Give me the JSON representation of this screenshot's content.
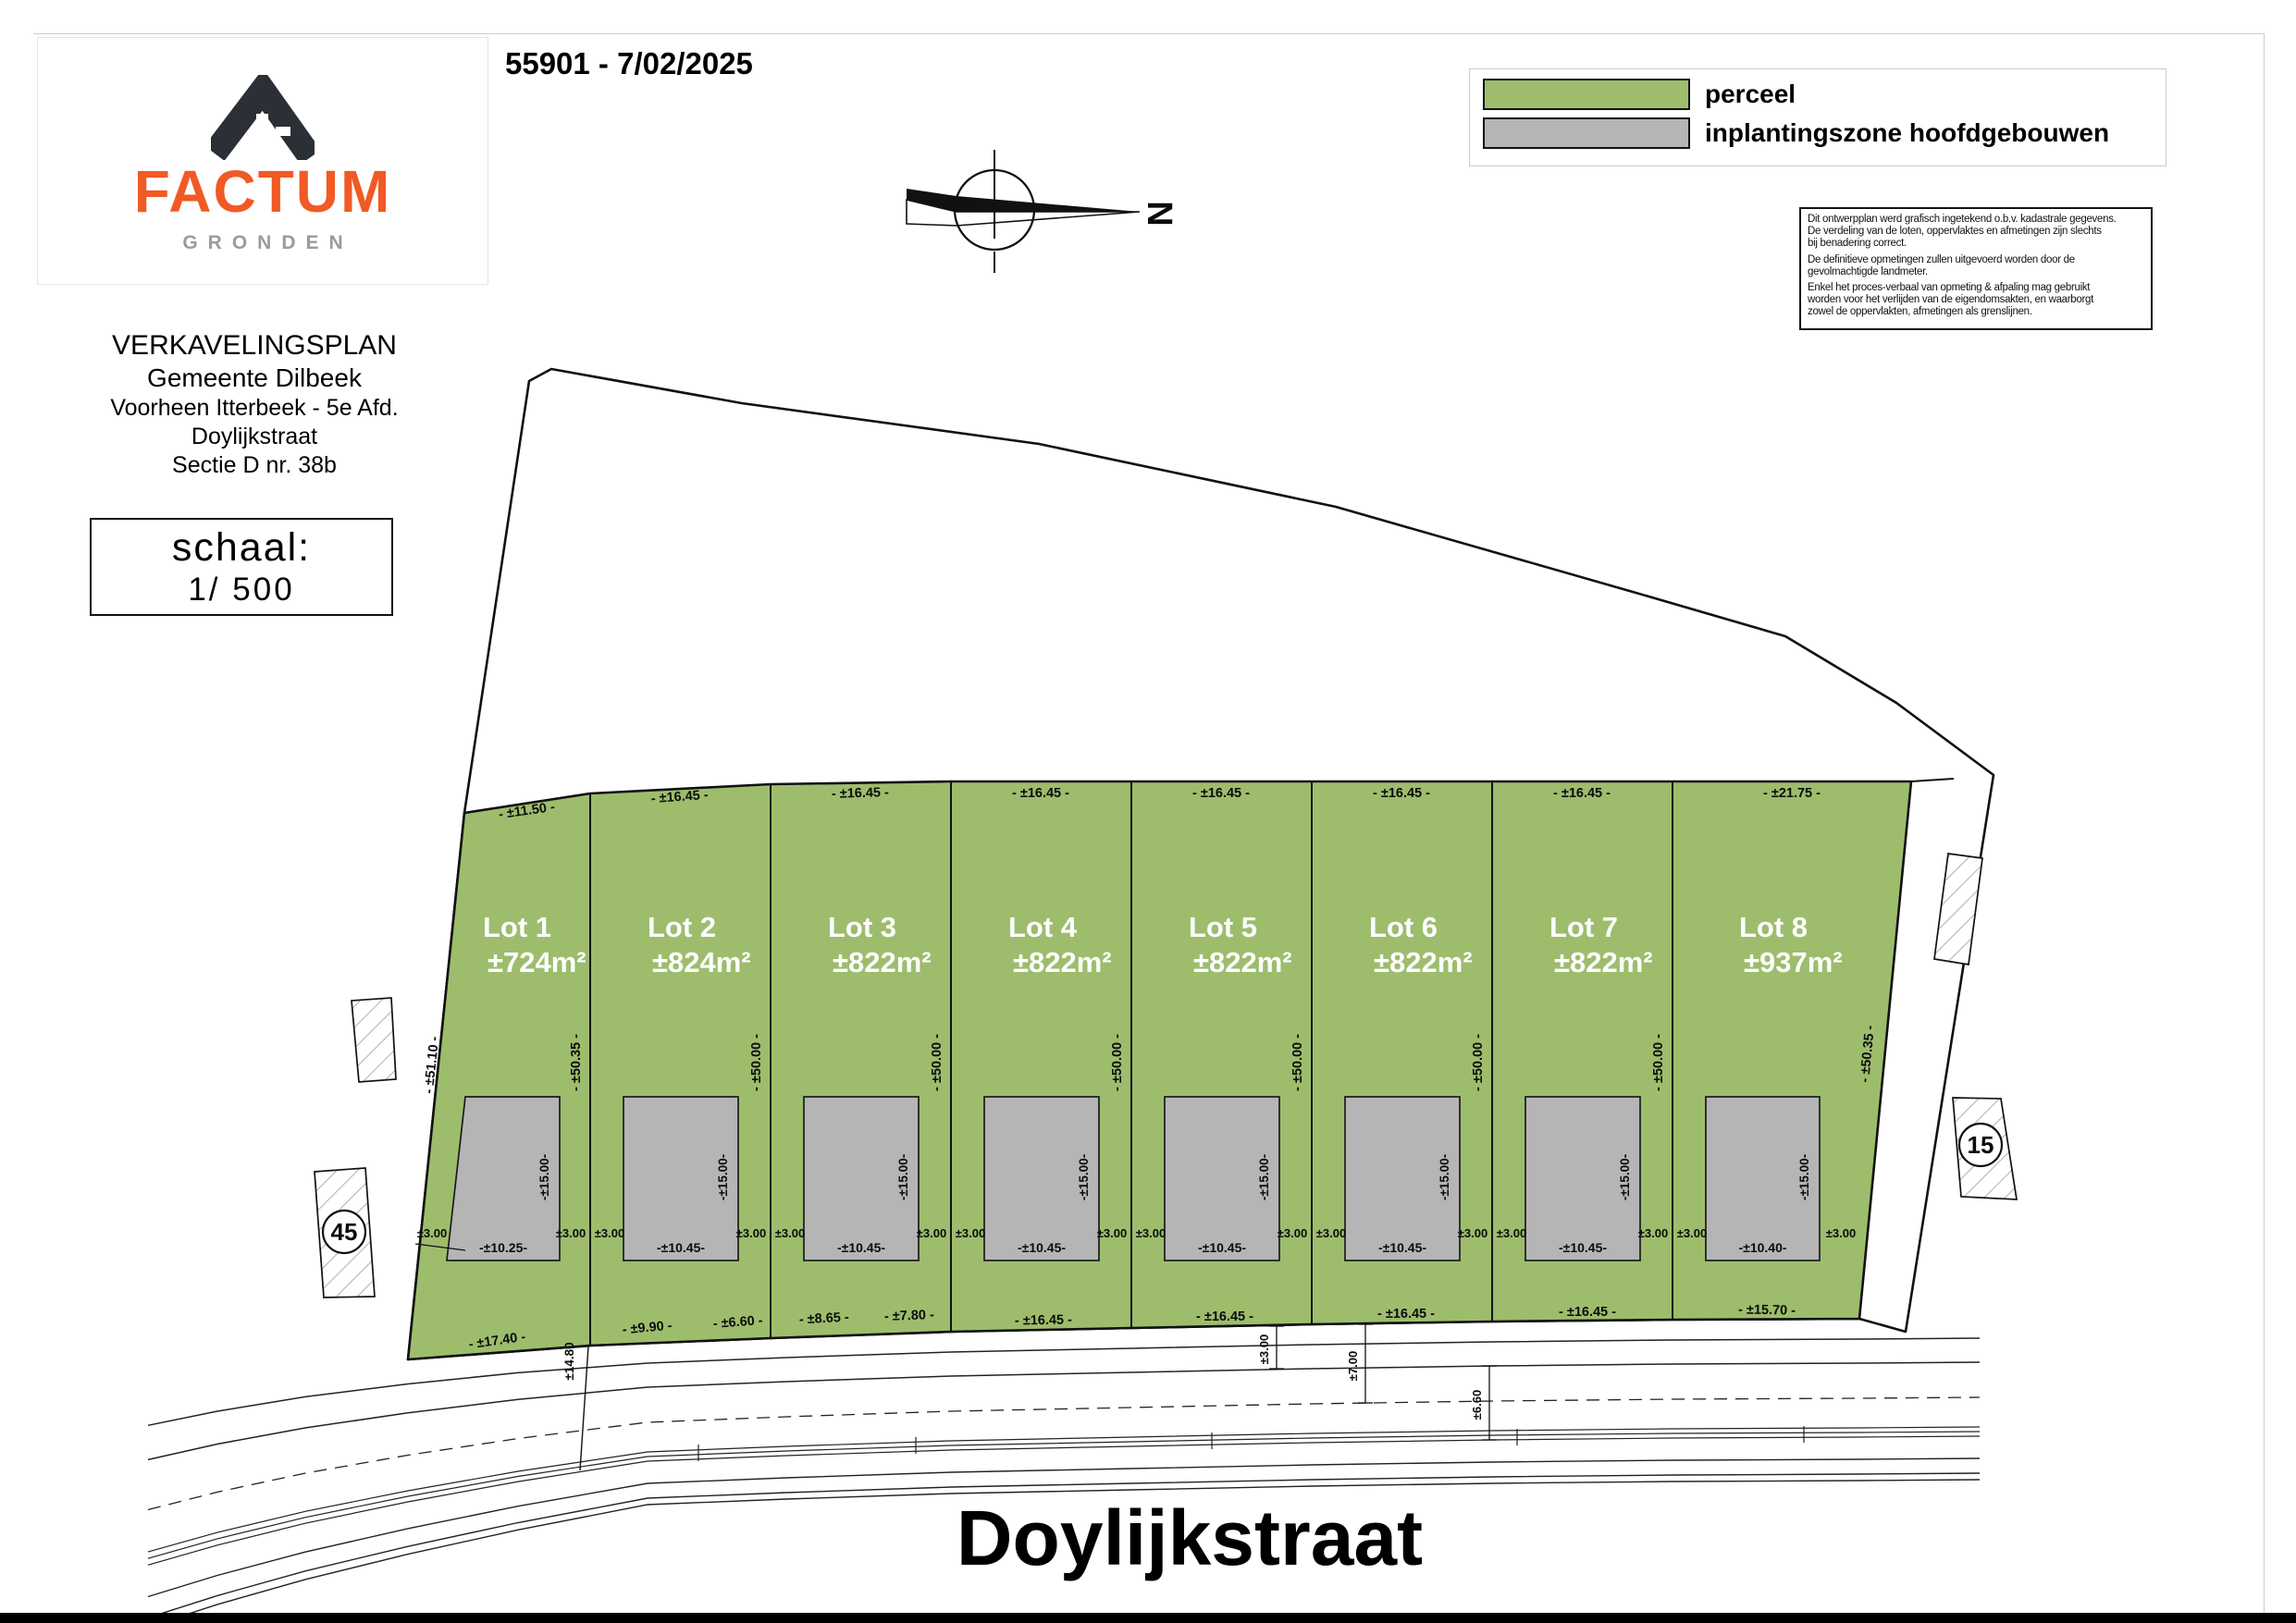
{
  "header": {
    "title": "55901 - 7/02/2025"
  },
  "logo": {
    "brand": "FACTUM",
    "subtitle": "GRONDEN",
    "brand_color": "#f15a24",
    "subtitle_color": "#9b9b9b",
    "icon_color": "#2b2f36",
    "icon": "chevron-mountain-f-icon"
  },
  "title_block": {
    "lines": [
      "VERKAVELINGSPLAN",
      "Gemeente Dilbeek",
      "Voorheen Itterbeek - 5e Afd.",
      "Doylijkstraat",
      "Sectie D nr. 38b"
    ]
  },
  "scale_box": {
    "label": "schaal:",
    "value": "1/ 500"
  },
  "legend": {
    "items": [
      {
        "label": "perceel",
        "color": "#9dbd6d"
      },
      {
        "label": "inplantingszone hoofdgebouwen",
        "color": "#b5b5b5"
      }
    ]
  },
  "disclaimer": {
    "paragraphs": [
      [
        "Dit ontwerpplan werd grafisch ingetekend o.b.v. kadastrale gegevens.",
        "De verdeling van de loten, oppervlaktes en afmetingen zijn slechts",
        "bij benadering correct."
      ],
      [
        "De definitieve opmetingen zullen uitgevoerd worden door de",
        "gevolmachtigde landmeter."
      ],
      [
        "Enkel het proces-verbaal van opmeting & afpaling mag gebruikt",
        "worden voor het verlijden van de eigendomsakten, en waarborgt",
        "zowel de oppervlakten, afmetingen als grenslijnen."
      ]
    ]
  },
  "compass": {
    "north_label": "N"
  },
  "street": {
    "name": "Doylijkstraat"
  },
  "neighbors": {
    "left_house_number": "45",
    "right_house_number": "15"
  },
  "plan": {
    "colors": {
      "parcel": "#9dbd6d",
      "zone": "#b5b5b5",
      "line": "#111111"
    },
    "lots": [
      {
        "name": "Lot 1",
        "area": "±724m²",
        "top_width": "- ±11.50 -",
        "zone_width": "-±10.25-",
        "zone_depth": "-±15.00-"
      },
      {
        "name": "Lot 2",
        "area": "±824m²",
        "top_width": "- ±16.45 -",
        "zone_width": "-±10.45-",
        "zone_depth": "-±15.00-"
      },
      {
        "name": "Lot 3",
        "area": "±822m²",
        "top_width": "- ±16.45 -",
        "zone_width": "-±10.45-",
        "zone_depth": "-±15.00-"
      },
      {
        "name": "Lot 4",
        "area": "±822m²",
        "top_width": "- ±16.45 -",
        "zone_width": "-±10.45-",
        "zone_depth": "-±15.00-"
      },
      {
        "name": "Lot 5",
        "area": "±822m²",
        "top_width": "- ±16.45 -",
        "zone_width": "-±10.45-",
        "zone_depth": "-±15.00-"
      },
      {
        "name": "Lot 6",
        "area": "±822m²",
        "top_width": "- ±16.45 -",
        "zone_width": "-±10.45-",
        "zone_depth": "-±15.00-"
      },
      {
        "name": "Lot 7",
        "area": "±822m²",
        "top_width": "- ±16.45 -",
        "zone_width": "-±10.45-",
        "zone_depth": "-±15.00-"
      },
      {
        "name": "Lot 8",
        "area": "±937m²",
        "top_width": "- ±21.75 -",
        "zone_width": "-±10.40-",
        "zone_depth": "-±15.00-"
      }
    ],
    "side_boundaries": {
      "left": "- ±51.10 -",
      "dividers": [
        "- ±50.35 -",
        "- ±50.00 -",
        "- ±50.00 -",
        "- ±50.00 -",
        "- ±50.00 -",
        "- ±50.00 -",
        "- ±50.00 -"
      ],
      "right": "- ±50.35 -"
    },
    "frontage_labels": [
      "- ±17.40 -",
      "- ±9.90 -",
      "- ±6.60 -",
      "- ±8.65 -",
      "- ±7.80 -",
      "- ±16.45 -",
      "- ±16.45 -",
      "- ±16.45 -",
      "- ±16.45 -",
      "- ±15.70 -"
    ],
    "setback_label": "±3.00",
    "corner_depth": "±14.80",
    "road_dims": [
      "±3.00",
      "±7.00",
      "±6.60"
    ]
  }
}
